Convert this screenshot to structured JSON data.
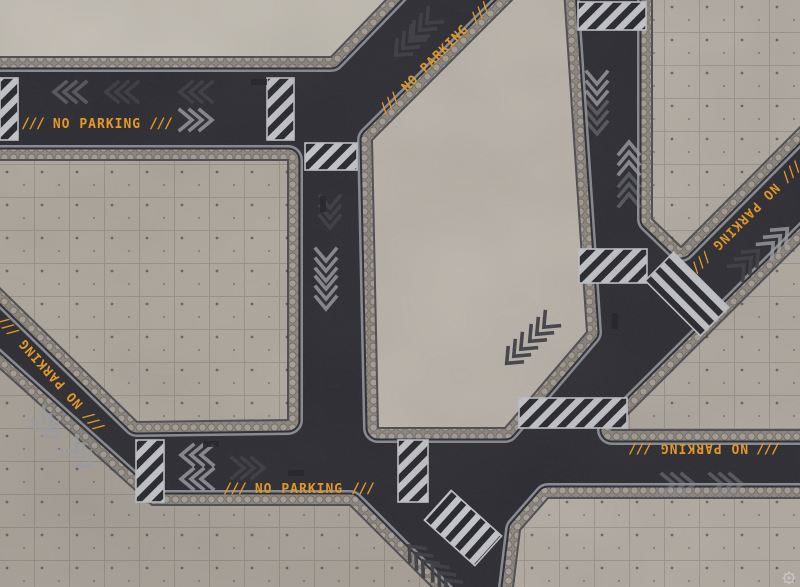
{
  "mat": {
    "signs": {
      "no_parking_label": "NO PARKING",
      "hazard_slashes": "///"
    },
    "logo": {
      "icon": "gear-icon"
    },
    "colors": {
      "asphalt": "#2a2a32",
      "concrete": "#b7b1a8",
      "concrete_light": "#c5c0b6",
      "concrete_dark": "#aaa39a",
      "cobble_edging": "#8d8880",
      "curb_line": "#9a9ea6",
      "hazard_stripe": "#c6c8cc",
      "marking_orange": "#ee9c1c",
      "chevron_light": "#9fa1a8",
      "chevron_dark": "#3a3a42"
    }
  }
}
